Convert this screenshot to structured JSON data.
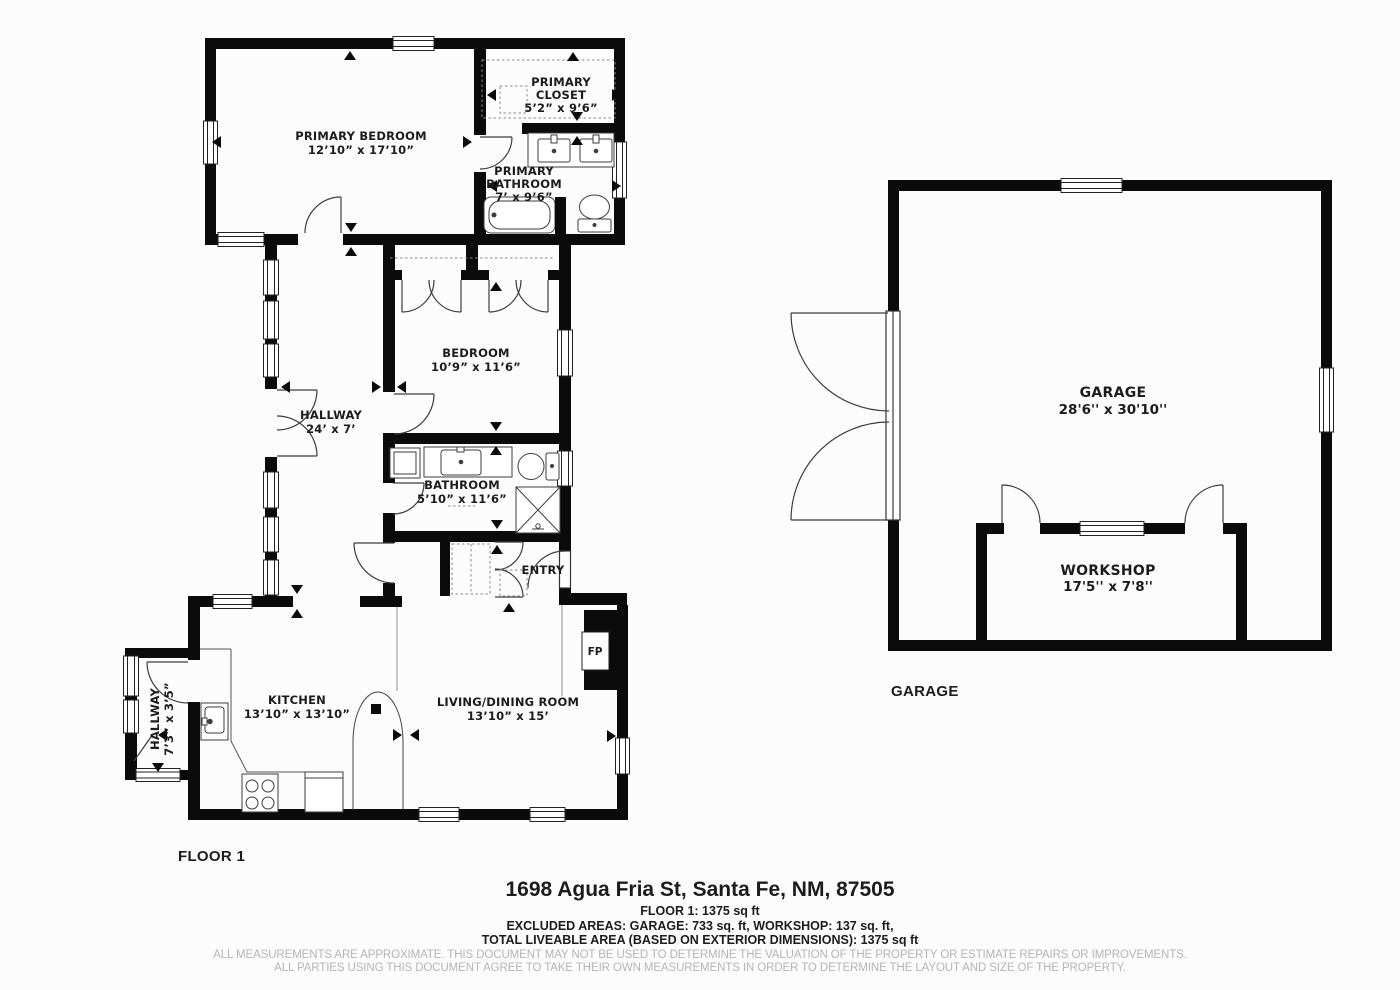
{
  "document": {
    "floor_label": "FLOOR 1",
    "garage_structure_label": "GARAGE",
    "address": "1698 Agua Fria St, Santa Fe, NM, 87505",
    "area_lines": [
      "FLOOR 1: 1375 sq ft",
      "EXCLUDED AREAS: GARAGE: 733 sq. ft, WORKSHOP: 137 sq. ft,",
      "TOTAL LIVEABLE AREA (BASED ON EXTERIOR DIMENSIONS): 1375 sq ft"
    ],
    "disclaimer_lines": [
      "ALL MEASUREMENTS ARE APPROXIMATE. THIS DOCUMENT MAY NOT BE USED TO DETERMINE THE VALUATION OF THE PROPERTY OR ESTIMATE REPAIRS OR IMPROVEMENTS.",
      "ALL PARTIES USING THIS DOCUMENT AGREE TO TAKE THEIR OWN MEASUREMENTS IN ORDER TO DETERMINE THE LAYOUT AND SIZE OF THE PROPERTY."
    ]
  },
  "rooms": {
    "primary_bedroom": {
      "name": "PRIMARY BEDROOM",
      "dims": "12’10” x 17’10”"
    },
    "primary_closet": {
      "name_line1": "PRIMARY",
      "name_line2": "CLOSET",
      "dims": "5’2” x 9’6”"
    },
    "primary_bathroom": {
      "name_line1": "PRIMARY",
      "name_line2": "BATHROOM",
      "dims": "7’ x 9’6”"
    },
    "bedroom": {
      "name": "BEDROOM",
      "dims": "10’9” x 11’6”"
    },
    "hallway": {
      "name": "HALLWAY",
      "dims": "24’ x 7’"
    },
    "bathroom": {
      "name": "BATHROOM",
      "dims": "5’10” x 11’6”"
    },
    "entry": {
      "name": "ENTRY"
    },
    "kitchen": {
      "name": "KITCHEN",
      "dims": "13’10” x 13’10”"
    },
    "living_dining": {
      "name": "LIVING/DINING ROOM",
      "dims": "13’10” x 15’"
    },
    "hallway_small": {
      "name": "HALLWAY",
      "dims": "7’3” x 3’5”"
    },
    "fireplace": {
      "abbr": "FP"
    },
    "garage": {
      "name": "GARAGE",
      "dims": "28'6'' x 30'10''"
    },
    "workshop": {
      "name": "WORKSHOP",
      "dims": "17'5'' x 7'8''"
    }
  },
  "colors": {
    "wall": "#0b0b0b",
    "text": "#1c1c1c",
    "muted_text": "#b5b5b5",
    "background": "#fcfcfc",
    "fixture_line": "#3d3d3d"
  }
}
